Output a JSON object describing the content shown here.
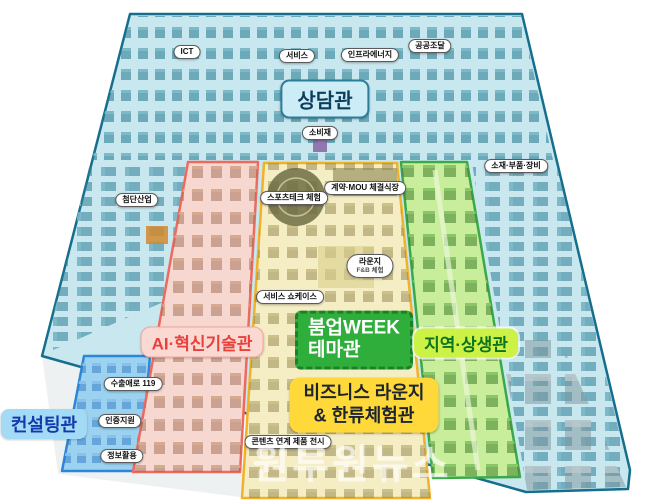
{
  "zones": {
    "sangdam": {
      "label": "상담관"
    },
    "ai": {
      "label": "AI·혁신기술관"
    },
    "boomup": {
      "line1": "붐업WEEK",
      "line2": "테마관"
    },
    "region": {
      "label": "지역·상생관"
    },
    "business": {
      "line1": "비즈니스 라운지",
      "line2": "& 한류체험관"
    },
    "consulting": {
      "label": "컨설팅관"
    }
  },
  "pills": [
    {
      "text": "ICT"
    },
    {
      "text": "서비스"
    },
    {
      "text": "인프라에너지"
    },
    {
      "text": "공공조달"
    },
    {
      "text": "소비재"
    },
    {
      "text": "첨단산업"
    },
    {
      "text": "소재·부품·장비"
    },
    {
      "text": "스포츠테크 체험"
    },
    {
      "text": "계약·MOU 체결식장"
    },
    {
      "text": "서비스 쇼케이스"
    },
    {
      "text": "수출애로 119"
    },
    {
      "text": "인증지원"
    },
    {
      "text": "정보활용"
    },
    {
      "text": "콘텐츠 연계 제품 전시"
    }
  ],
  "lounge": {
    "line1": "라운지",
    "line2": "F&B 체험"
  },
  "watermark": "원투원뉴스",
  "colors": {
    "hall_fill": "#c9e7ef",
    "hall_border": "#156f8c",
    "ai_fill": "#f7d8d1",
    "ai_border": "#ee6a5e",
    "boomup_fill": "#f5edc4",
    "boomup_border": "#f1b228",
    "boomup_badge": "#2fae3c",
    "region_fill": "#c9ee9b",
    "region_border": "#3aa94a",
    "region_badge": "#cbf244",
    "business_badge": "#ffd83a",
    "consulting_fill": "#9bd2f0",
    "consulting_border": "#2e86d8"
  }
}
